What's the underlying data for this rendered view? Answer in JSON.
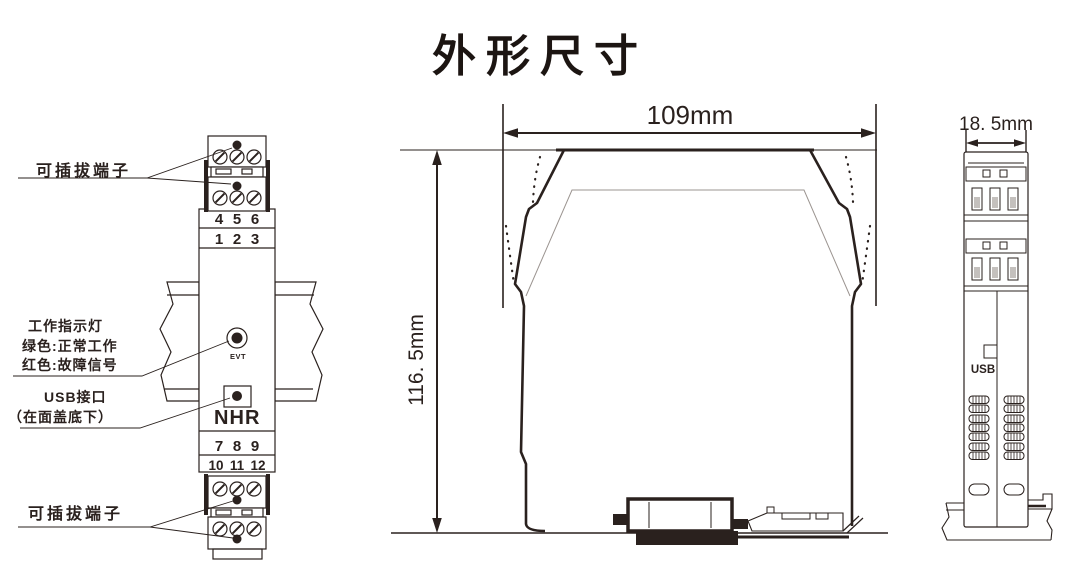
{
  "title": "外形尺寸",
  "colors": {
    "line": "#2a211e",
    "red": "#e60012",
    "inner_gray": "#9b9490",
    "slot_fill": "#c4c0bd"
  },
  "front_view": {
    "top_terminal_label": "可插拔端子",
    "bottom_terminal_label": "可插拔端子",
    "indicator_label_line1": "工作指示灯",
    "indicator_label_line2": "绿色:正常工作",
    "indicator_label_line3": "红色:故障信号",
    "usb_label_line1": "USB接口",
    "usb_label_line2": "（在面盖底下）",
    "led_text": "EVT",
    "logo": {
      "letter1": "N",
      "letter2": "H",
      "letter3": "R"
    },
    "numbers": {
      "row1": [
        "4",
        "5",
        "6"
      ],
      "row2": [
        "1",
        "2",
        "3"
      ],
      "row3": [
        "7",
        "8",
        "9"
      ],
      "row4": [
        "10",
        "11",
        "12"
      ]
    }
  },
  "side_view": {
    "width_label": "109mm",
    "height_label": "116. 5mm"
  },
  "end_view": {
    "width_label": "18. 5mm",
    "usb_text": "USB"
  }
}
